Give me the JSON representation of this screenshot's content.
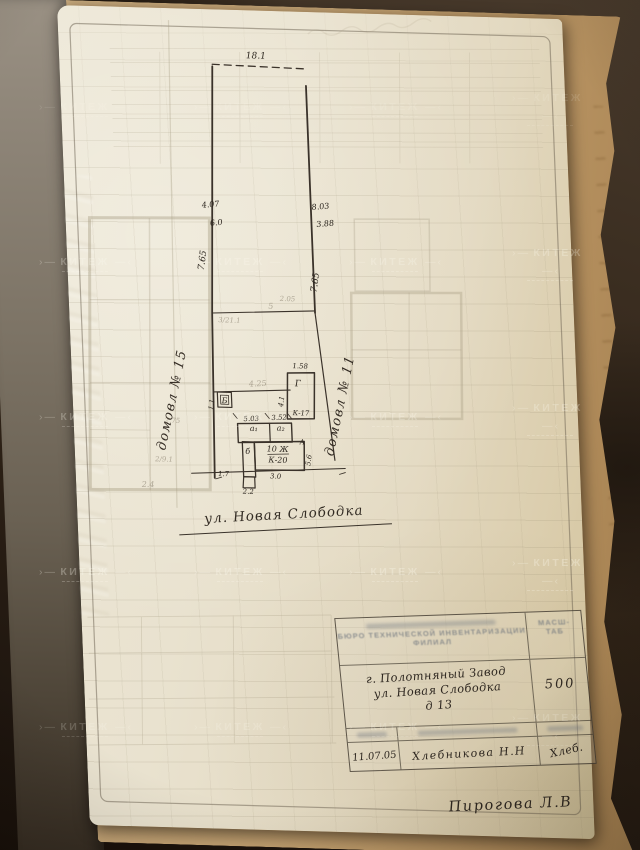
{
  "colors": {
    "paper": "#e9e2cf",
    "ink": "#3a322a",
    "pencil": "#786e5d",
    "blueprint": "#a79d84",
    "underpage_tan": "#c4a271",
    "background_brown": "#2e2216"
  },
  "watermark": {
    "text": "КИТЕЖ"
  },
  "plan": {
    "street_label": "ул. Новая Слободка",
    "labels": [
      {
        "t": "18.1",
        "x": 197,
        "y": 48,
        "s": 9
      },
      {
        "t": "4.07",
        "x": 146,
        "y": 198,
        "s": 8,
        "r": -6
      },
      {
        "t": "6.0",
        "x": 151,
        "y": 216,
        "s": 8,
        "r": -6
      },
      {
        "t": "8.03",
        "x": 256,
        "y": 197,
        "s": 8,
        "r": -6
      },
      {
        "t": "3.88",
        "x": 260,
        "y": 214,
        "s": 8,
        "r": -6
      },
      {
        "t": "7.65",
        "x": 138,
        "y": 252,
        "s": 9,
        "r": -80
      },
      {
        "t": "7.65",
        "x": 250,
        "y": 271,
        "s": 9,
        "r": -80
      },
      {
        "t": "домовл № 15",
        "x": 103,
        "y": 393,
        "s": 13,
        "r": -76,
        "cls": "hand"
      },
      {
        "t": "домовл № 11",
        "x": 271,
        "y": 394,
        "s": 13,
        "r": -76,
        "cls": "hand"
      },
      {
        "t": "1.58",
        "x": 229,
        "y": 357,
        "s": 7
      },
      {
        "t": "Г",
        "x": 226,
        "y": 375,
        "s": 9
      },
      {
        "t": "К-17",
        "x": 228,
        "y": 404,
        "s": 7
      },
      {
        "t": "4.1",
        "x": 211,
        "y": 391,
        "s": 7,
        "r": -80
      },
      {
        "t": "Б",
        "x": 152,
        "y": 394,
        "s": 8
      },
      {
        "t": "1.1",
        "x": 141,
        "y": 396,
        "s": 7,
        "r": -80
      },
      {
        "t": "5.03",
        "x": 178,
        "y": 411,
        "s": 7,
        "r": -3
      },
      {
        "t": "3.52",
        "x": 206,
        "y": 409,
        "s": 7,
        "r": -3
      },
      {
        "t": "а₁",
        "x": 180,
        "y": 421,
        "s": 8
      },
      {
        "t": "а₂",
        "x": 207,
        "y": 420,
        "s": 8
      },
      {
        "t": "б",
        "x": 173,
        "y": 444,
        "s": 8
      },
      {
        "t": "10 Ж",
        "x": 203,
        "y": 441,
        "s": 8
      },
      {
        "t": "К-20",
        "x": 203,
        "y": 452,
        "s": 8
      },
      {
        "t": "3.0",
        "x": 200,
        "y": 468,
        "s": 7
      },
      {
        "t": "5.6",
        "x": 236,
        "y": 449,
        "s": 7,
        "r": -80
      },
      {
        "t": "2.2",
        "x": 172,
        "y": 484,
        "s": 7
      },
      {
        "t": "А",
        "x": 228,
        "y": 433,
        "s": 7
      },
      {
        "t": "1.7",
        "x": 148,
        "y": 467,
        "s": 7
      },
      {
        "t": "2.05",
        "x": 219,
        "y": 290,
        "s": 7,
        "cls": "pencil"
      },
      {
        "t": "5",
        "x": 202,
        "y": 298,
        "s": 8,
        "cls": "pencil"
      },
      {
        "t": "3/21.1",
        "x": 160,
        "y": 313,
        "s": 7,
        "cls": "pencil"
      },
      {
        "t": "4.25",
        "x": 186,
        "y": 376,
        "s": 8,
        "r": -4,
        "cls": "pencil"
      },
      {
        "t": "2.75",
        "x": 99,
        "y": 415,
        "s": 7,
        "cls": "pencil"
      },
      {
        "t": "2/9.1",
        "x": 89,
        "y": 454,
        "s": 7,
        "cls": "pencil"
      },
      {
        "t": "2.4",
        "x": 72,
        "y": 480,
        "s": 8,
        "cls": "pencil"
      }
    ]
  },
  "title_block": {
    "org_line1": "БЮРО ТЕХНИЧЕСКОЙ ИНВЕНТАРИЗАЦИИ",
    "org_line2": "ФИЛИАЛ",
    "scale_label_line1": "Масш-",
    "scale_label_line2": "таб",
    "address_line1": "г. Полотняный Завод",
    "address_line2": "ул. Новая Слободка",
    "address_line3": "д 13",
    "scale_value": "500",
    "date": "11.07.05",
    "executor": "Хлебникова Н.Н",
    "signature": "Хлеб.",
    "approved_name": "Пирогова Л.В"
  }
}
